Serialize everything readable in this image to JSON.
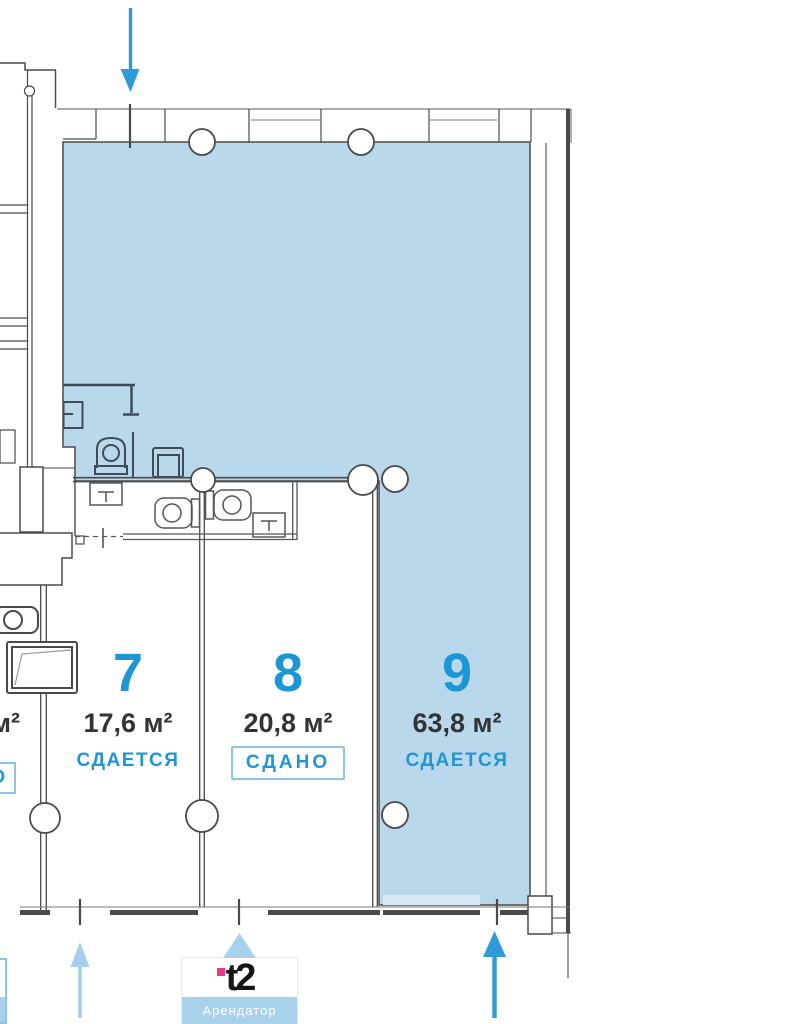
{
  "rooms": {
    "room7": {
      "number": "7",
      "area": "17,6 м²",
      "status": "СДАЕТСЯ"
    },
    "room8": {
      "number": "8",
      "area": "20,8 м²",
      "status": "СДАНО"
    },
    "room9": {
      "number": "9",
      "area": "63,8 м²",
      "status": "СДАЕТСЯ"
    }
  },
  "left_room": {
    "area_unit": "м²",
    "status": "СДАНО"
  },
  "tenant_card": {
    "logo": "t2",
    "label": "Арендатор"
  },
  "colors": {
    "room_highlight_fill": "#b9d8eb",
    "accent_blue": "#2196d3",
    "light_blue": "#a8d2ec",
    "badge_border": "#8ec4e6",
    "dark_text": "#333333",
    "wall_gray": "#4a4a4a",
    "brand_pink": "#f0368b"
  }
}
